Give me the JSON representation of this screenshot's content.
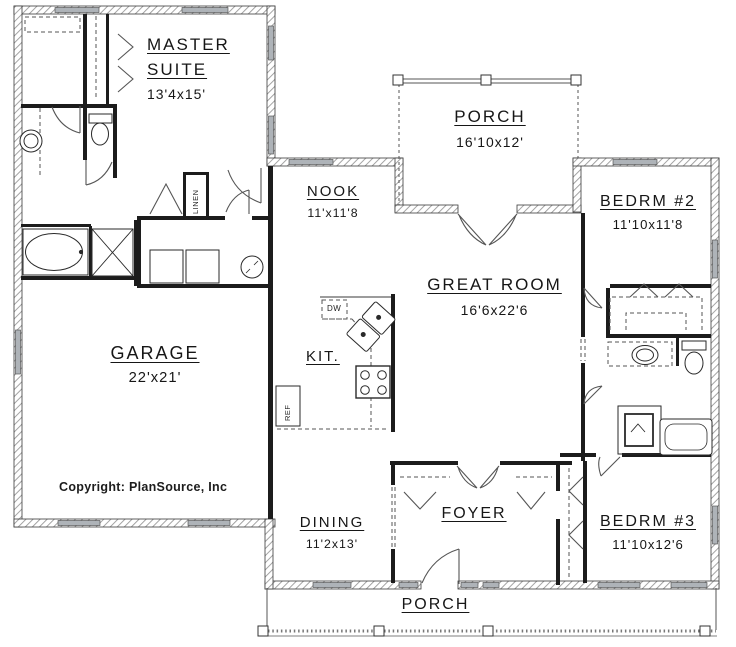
{
  "rooms": [
    {
      "id": "master-suite",
      "name": "MASTER SUITE",
      "dims": "13'4x15'"
    },
    {
      "id": "porch-top",
      "name": "PORCH",
      "dims": "16'10x12'"
    },
    {
      "id": "nook",
      "name": "NOOK",
      "dims": "11'x11'8"
    },
    {
      "id": "bedrm-2",
      "name": "BEDRM #2",
      "dims": "11'10x11'8"
    },
    {
      "id": "great-room",
      "name": "GREAT ROOM",
      "dims": "16'6x22'6"
    },
    {
      "id": "garage",
      "name": "GARAGE",
      "dims": "22'x21'"
    },
    {
      "id": "kitchen",
      "name": "KIT."
    },
    {
      "id": "dining",
      "name": "DINING",
      "dims": "11'2x13'"
    },
    {
      "id": "foyer",
      "name": "FOYER"
    },
    {
      "id": "bedrm-3",
      "name": "BEDRM #3",
      "dims": "11'10x12'6"
    },
    {
      "id": "porch-bottom",
      "name": "PORCH"
    }
  ],
  "annotations": {
    "copyright": "Copyright: PlanSource, Inc"
  },
  "fixtures": {
    "labels": {
      "linen": "LINEN",
      "dishwasher": "DW",
      "refrigerator": "REF"
    },
    "items": [
      "bathtub",
      "shower",
      "sink",
      "toilet",
      "washer",
      "dryer",
      "water-heater",
      "kitchen-corner-sink",
      "stove",
      "vanity-sink",
      "bathtub-2",
      "toilet-2",
      "water-heater-2"
    ]
  },
  "colors": {
    "background": "#ffffff",
    "line": "#1c1c1c",
    "wall_hatch": "#9a9a9a",
    "window_fill": "#aeb3b8"
  }
}
